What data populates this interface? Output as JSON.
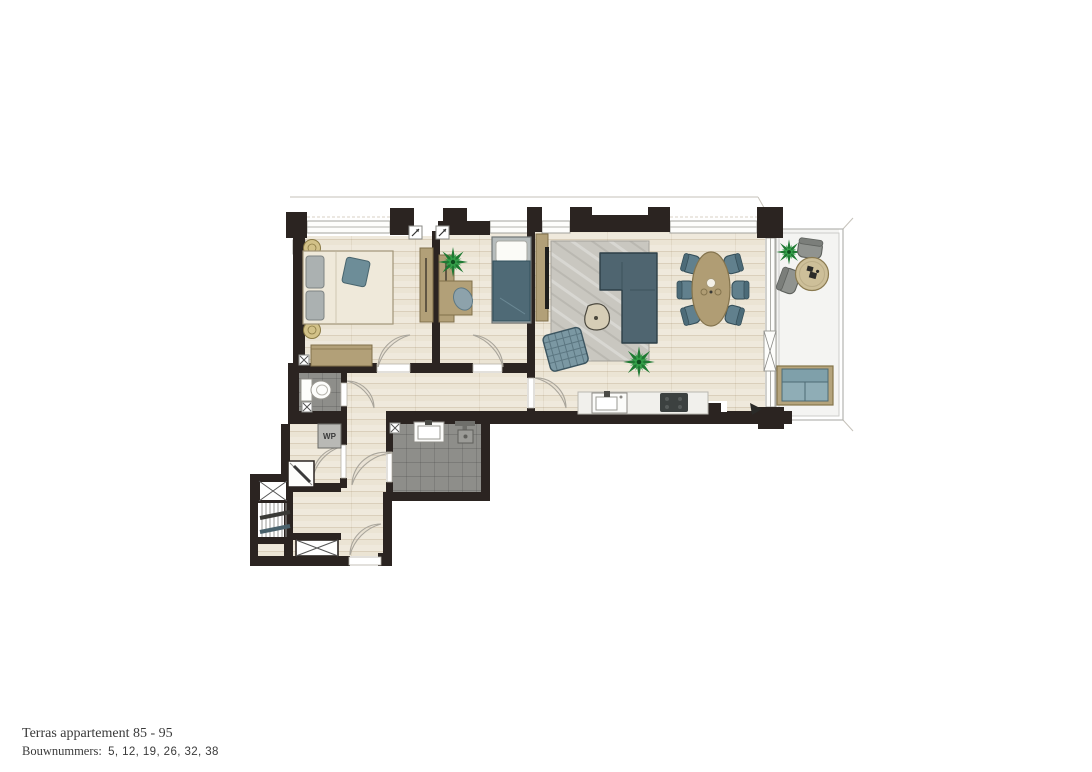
{
  "caption": {
    "line1": "Terras appartement 85 - 95",
    "line2_label": "Bouwnummers:",
    "line2_numbers": "5, 12, 19, 26, 32, 38"
  },
  "labels": {
    "heat_pump": "WP"
  },
  "colors": {
    "wall": "#2b2421",
    "wood_floor": "#ebe4d4",
    "tile_floor": "#8e8e8a",
    "rug": "#c9c7c0",
    "terrace_floor": "#f4f4f2",
    "upholstery_teal": "#5f7d8a",
    "sofa_slate": "#4f6570",
    "furniture_tan": "#b2a078",
    "plant_green": "#1f7a33",
    "appliance_grey": "#a8a8a4"
  },
  "icons": {
    "ventilation_point": "small-square-with-diagonal-arrow",
    "extraction_valve": "small-square-with-x",
    "duct_shaft": "rectangle-with-x-cross",
    "stairs": "striped-treads-with-handrails",
    "door_swing": "quarter-arc-lens",
    "terrace_door": "rectangle-with-x-glazing",
    "swing_direction_arrow": "small-black-triangle"
  }
}
